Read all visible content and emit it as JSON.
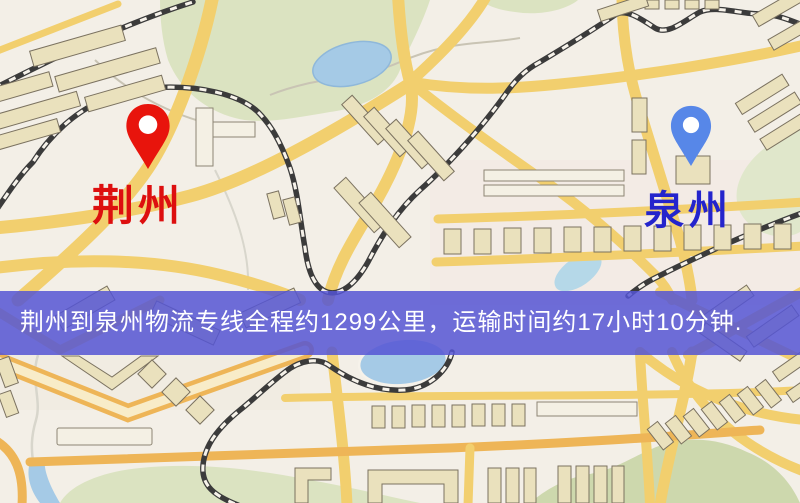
{
  "map": {
    "origin": {
      "name": "荆州",
      "pin_color": "#e8140c",
      "label_color": "#dd0f0f",
      "icon": "map-pin-icon"
    },
    "destination": {
      "name": "泉州",
      "pin_color": "#5787e8",
      "label_color": "#2424cc",
      "icon": "map-pin-icon"
    },
    "banner": {
      "text": "荆州到泉州物流专线全程约1299公里，运输时间约17小时10分钟.",
      "background": "#5555d4",
      "text_color": "#ffffff"
    },
    "route": {
      "distance_km": 1299,
      "duration_text": "17小时10分钟"
    }
  }
}
